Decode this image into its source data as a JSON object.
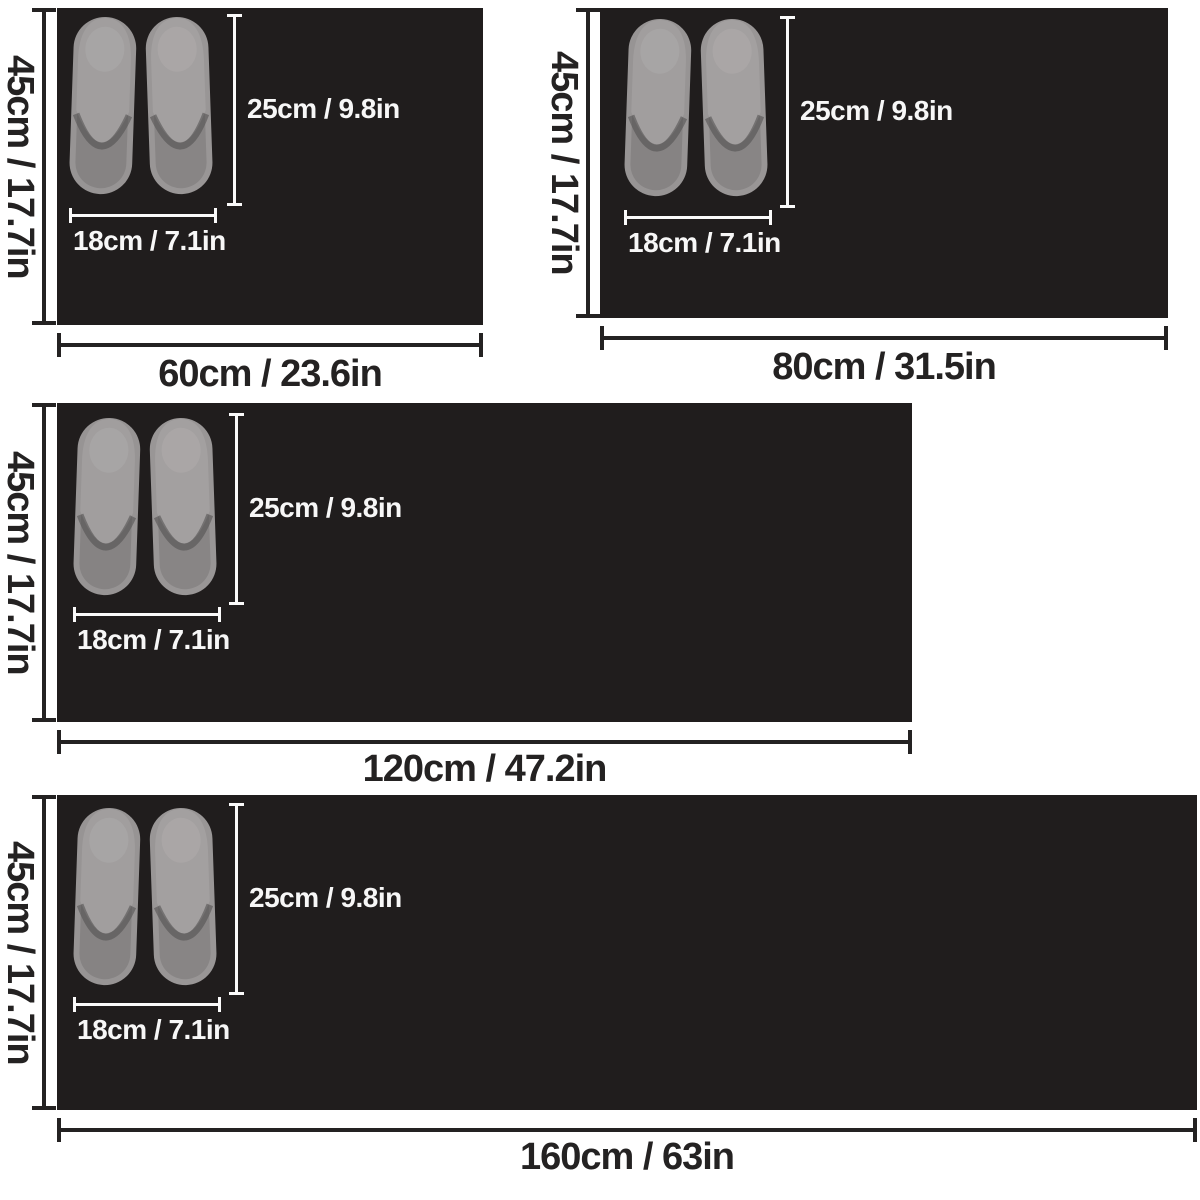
{
  "image_type": "product-size-chart",
  "product": "black floor mat with pair of grey slippers for scale",
  "colors": {
    "page_background": "#ffffff",
    "mat": "#201d1d",
    "outer_text": "#242222",
    "outer_lines": "#242222",
    "inner_text": "#f7f7f7",
    "inner_lines": "#fafafa",
    "slipper_vamp": "#a3a0a0",
    "slipper_footbed": "#878484",
    "slipper_sole_rim": "#979494"
  },
  "slipper_annotations_note": "every panel shows the same slipper pair with identical length and width callouts",
  "panels": [
    {
      "size_name": "60cm",
      "side_label": "45cm / 17.7in",
      "bottom_label": "60cm / 23.6in",
      "length_label": "25cm / 9.8in",
      "width_label": "18cm / 7.1in"
    },
    {
      "size_name": "80cm",
      "side_label": "45cm / 17.7in",
      "bottom_label": "80cm / 31.5in",
      "length_label": "25cm / 9.8in",
      "width_label": "18cm / 7.1in"
    },
    {
      "size_name": "120cm",
      "side_label": "45cm / 17.7in",
      "bottom_label": "120cm / 47.2in",
      "length_label": "25cm / 9.8in",
      "width_label": "18cm / 7.1in"
    },
    {
      "size_name": "160cm",
      "side_label": "45cm / 17.7in",
      "bottom_label": "160cm / 63in",
      "length_label": "25cm / 9.8in",
      "width_label": "18cm / 7.1in"
    }
  ]
}
